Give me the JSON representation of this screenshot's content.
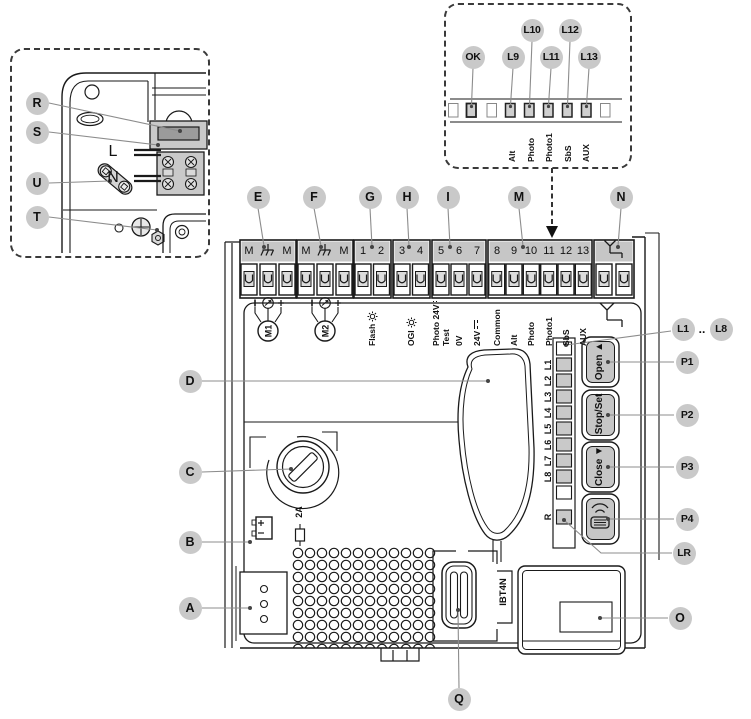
{
  "title": "control-board-overview-diagram",
  "colors": {
    "line": "#1a1a1a",
    "leader": "#8c8c8c",
    "bubble_fill": "#c9c9c9",
    "header_fill": "#c6c6c6",
    "terminal_fill": "#dcdcdc",
    "led_fill": "#c9c9c9",
    "fuse_window": "#9b9b9b",
    "background": "#ffffff"
  },
  "icons": {
    "earth_ground_icon": "⏚",
    "antenna_icon": "Y-ground",
    "lamp_icon": "☼",
    "dc_voltage_icon": "⎓",
    "nc_contact_icon": "—/",
    "no_contact_icon": "—\\",
    "encoder_icon": "circle-arrow",
    "radio_remote_icon": "≡)))",
    "battery_icon": "+/-",
    "fuse_icon": "inline-fuse",
    "motor_icon": "M-circle",
    "dashed-arrow-icon": "▼"
  },
  "callouts": {
    "r": "R",
    "s": "S",
    "u": "U",
    "t": "T",
    "ok": "OK",
    "l9": "L9",
    "l10": "L10",
    "l11": "L11",
    "l12": "L12",
    "l13": "L13",
    "e": "E",
    "f": "F",
    "g": "G",
    "h": "H",
    "i": "I",
    "m": "M",
    "n": "N",
    "a": "A",
    "b": "B",
    "c": "C",
    "d": "D",
    "o": "O",
    "q": "Q",
    "lr": "LR",
    "p1": "P1",
    "p2": "P2",
    "p3": "P3",
    "p4": "P4",
    "l1": "L1",
    "range_dots": "..",
    "l8": "L8"
  },
  "inset": {
    "line": "L",
    "neutral": "N"
  },
  "led_panel": {
    "labels": {
      "alt": "Alt",
      "photo": "Photo",
      "photo1": "Photo1",
      "sbs": "SbS",
      "aux": "AUX"
    }
  },
  "terminals": {
    "block_e": {
      "l": "M",
      "r": "M"
    },
    "block_f": {
      "l": "M",
      "r": "M"
    },
    "block_g": [
      "1",
      "2"
    ],
    "block_h": [
      "3",
      "4"
    ],
    "block_i": [
      "5",
      "6",
      "7"
    ],
    "block_m": [
      "8",
      "9",
      "10",
      "11",
      "12",
      "13"
    ]
  },
  "io_labels": {
    "m1": "M1",
    "m2": "M2",
    "flash": "Flash",
    "ogi": "OGI",
    "photo_test_1": "Photo 24V",
    "photo_test_2": "Test",
    "v0": "0V",
    "v24": "24V",
    "common": "Common",
    "alt": "Alt",
    "photo": "Photo",
    "photo1": "Photo1",
    "sbs": "SbS",
    "aux": "AUX"
  },
  "board": {
    "fuse_rating": "2A",
    "connector": "IBT4N"
  },
  "right_panel": {
    "led_labels": [
      "L1",
      "L2",
      "L3",
      "L4",
      "L5",
      "L6",
      "L7",
      "L8"
    ],
    "led_r": "R",
    "buttons": {
      "p1_label": "Open ▲",
      "p2_label": "Stop/Set",
      "p3_label": "Close ▼"
    }
  }
}
